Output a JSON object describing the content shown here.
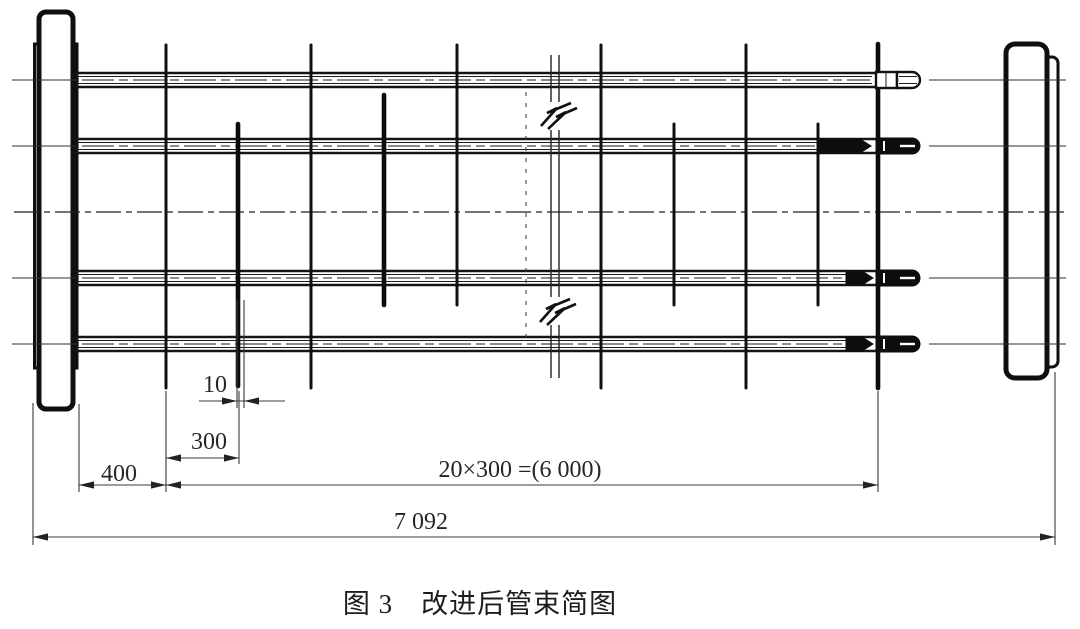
{
  "figure": {
    "caption": "图 3　改进后管束简图"
  },
  "dimensions": {
    "baffle_thickness": "10",
    "baffle_spacing": "300",
    "first_span": "400",
    "baffled_length_total": "20×300 =(6 000)",
    "overall_length": "7 092"
  },
  "colors": {
    "line": "#151515",
    "dimension": "#3a3a3a",
    "text": "#262626",
    "background": "#ffffff"
  }
}
